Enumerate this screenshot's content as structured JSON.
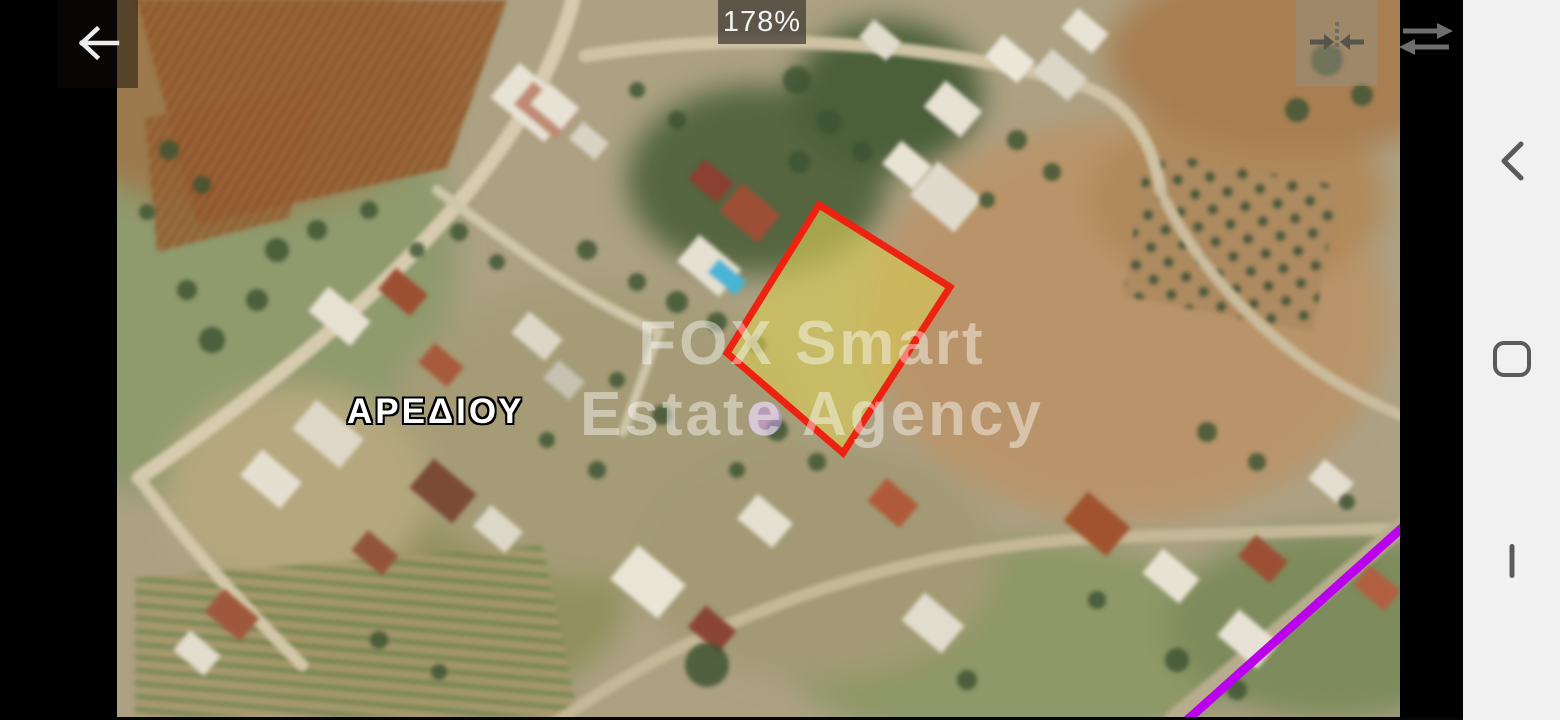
{
  "viewer": {
    "zoom_level": "178%",
    "icons": {
      "back": "arrow-left",
      "fit": "collapse-horizontal",
      "swap": "swap-horizontal-arrows"
    }
  },
  "map": {
    "place_label": "ΑΡΕΔΙΟΥ",
    "watermark": {
      "line1": "FOX Smart",
      "line2": "Estate Agency"
    },
    "parcel": {
      "points": "702,205 833,287 726,453 610,353",
      "fill": "#d8cb55",
      "fill_opacity": "0.62",
      "stroke": "#ee2211",
      "stroke_width": "7"
    },
    "route": {
      "points": "1285,528 1068,722",
      "color": "#bb00ee",
      "width": "9"
    },
    "marker": {
      "color": "#c9a0e8",
      "opacity": "0.55"
    }
  },
  "android_nav": {
    "icons": {
      "back": "chevron-back",
      "home": "home",
      "recents": "recent-apps"
    }
  }
}
